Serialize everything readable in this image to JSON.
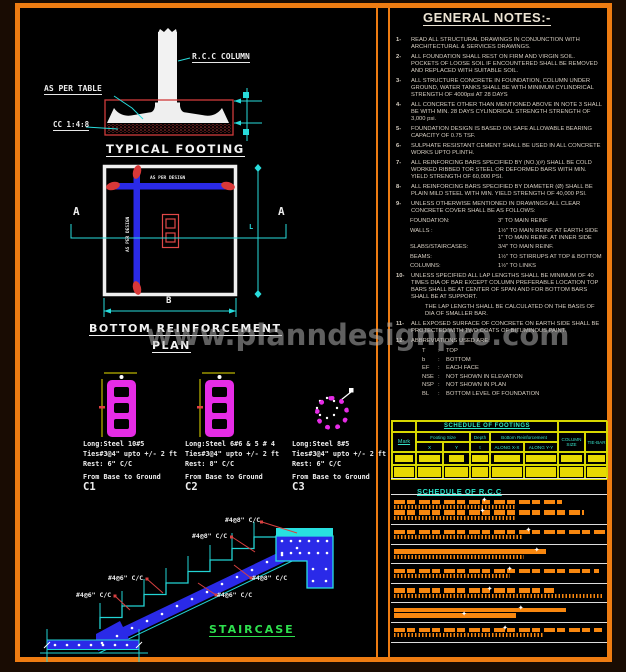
{
  "watermark": "www.planndesignpro.com",
  "footing_detail": {
    "title": "TYPICAL FOOTING",
    "column_label": "R.C.C COLUMN",
    "table_label": "AS PER TABLE",
    "cc_label": "CC 1:4:8"
  },
  "plan": {
    "title": "BOTTOM REINFORCEMENT",
    "title2": "PLAN",
    "bar_label": "AS PER DESIGN",
    "section_mark": "A",
    "dim_width": "B",
    "dim_len": "L"
  },
  "columns": [
    {
      "long": "Long:Steel  10#5",
      "ties": "Ties#3@4\" upto +/- 2 ft",
      "rest": "Rest: 6\" C/C",
      "range": "From Base to Ground",
      "mark": "C1"
    },
    {
      "long": "Long:Steel  6#6 & 5 # 4",
      "ties": "Ties#3@4\" upto +/- 2 ft",
      "rest": "Rest: 8\" C/C",
      "range": "From Base to Ground",
      "mark": "C2"
    },
    {
      "long": "Long:Steel  8#5",
      "ties": "Ties#3@4\" upto +/- 2 ft",
      "rest": "Rest: 6\" C/C",
      "range": "From Base to Ground",
      "mark": "C3"
    }
  ],
  "staircase": {
    "title": "STAIRCASE",
    "labels": [
      "#4@8\" C/C",
      "#4@8\" C/C",
      "#4@8\" C/C",
      "#4@6\" C/C",
      "#4@6\" C/C",
      "#4@6\" C/C"
    ]
  },
  "notes": {
    "title": "GENERAL NOTES:-",
    "blocks": [
      {
        "t": "note",
        "n": "1-",
        "x": "READ ALL STRUCTURAL DRAWINGS IN CONJUNCTION WITH ARCHITECTURAL & SERVICES DRAWINGS."
      },
      {
        "t": "note",
        "n": "2-",
        "x": "ALL FOUNDATION SHALL REST ON FIRM AND VIRGIN SOIL. POCKETS OF LOOSE SOIL IF ENCOUNTERED SHALL BE REMOVED AND REPLACED WITH SUITABLE SOIL."
      },
      {
        "t": "note",
        "n": "3-",
        "x": "ALL STRUCTURE CONCRETE IN FOUNDATION, COLUMN UNDER GROUND, WATER TANKS SHALL BE WITH MINIMUM CYLINDRICAL STRENGTH OF 4000psi AT 28 DAYS"
      },
      {
        "t": "note",
        "n": "4-",
        "x": "ALL CONCRETE OTHER THAN MENTIONED ABOVE IN NOTE 3 SHALL BE WITH MIN. 28 DAYS CYLINDRICAL STRENGTH STRENGTH OF 3,000 psi."
      },
      {
        "t": "note",
        "n": "5-",
        "x": "FOUNDATION DESIGN IS BASED ON SAFE ALLOWABLE BEARING CAPACITY OF 0.75 TSF."
      },
      {
        "t": "note",
        "n": "6-",
        "x": "SULPHATE RESISTANT CEMENT SHALL BE USED IN ALL CONCRETE WORKS UPTO PLINTH."
      },
      {
        "t": "note",
        "n": "7-",
        "x": "ALL REINFORCING BARS SPECIFIED BY (NO.)(#) SHALL BE COLD WORKED RIBBED TOR STEEL OR DEFORMED BARS WITH MIN. YIELD STRENGTH OF 60,000 PSI."
      },
      {
        "t": "note",
        "n": "8-",
        "x": "ALL REINFORCING BARS SPECIFIED BY DIAMETER (Ø) SHALL BE PLAIN MILD STEEL WITH MIN. YIELD STRENGTH OF 40,000 PSI."
      },
      {
        "t": "note",
        "n": "9-",
        "x": "UNLESS OTHERWISE MENTIONED IN DRAWINGS ALL CLEAR CONCRETE COVER SHALL BE AS FOLLOWS:"
      },
      {
        "t": "pair",
        "l": "FOUNDATION:",
        "v": "3\" TO MAIN REINF"
      },
      {
        "t": "pair",
        "l": "WALLS :",
        "v": "1½\" TO MAIN REINF. AT EARTH SIDE\n1\" TO MAIN REINF. AT INNER SIDE"
      },
      {
        "t": "pair",
        "l": "SLABS/STAIRCASES:",
        "v": "3/4\" TO MAIN REINF."
      },
      {
        "t": "pair",
        "l": "BEAMS:",
        "v": "1½\" TO STIRRUPS AT TOP & BOTTOM"
      },
      {
        "t": "pair",
        "l": "COLUMNS:",
        "v": "1½\" TO LINKS"
      },
      {
        "t": "note",
        "n": "10-",
        "x": "UNLESS SPECIFIED ALL LAP LENGTHS SHALL BE MINIMUM OF 40 TIMES DIA OF BAR EXCEPT COLUMN PREFERABLE LOCATION TOP BARS SHALL BE AT CENTER OF SPAN AND FOR BOTTOM BARS SHALL BE AT SUPPORT."
      },
      {
        "t": "cont",
        "x": "THE LAP LENGTH SHALL BE CALCULATED ON THE BASIS OF DIA OF SMALLER BAR."
      },
      {
        "t": "note",
        "n": "11-",
        "x": "ALL EXPOSED SURFACE OF CONCRETE ON EARTH SIDE SHALL BE PROTECTED WITH TWO COATS OF BITUMINOUS PAINT."
      },
      {
        "t": "note",
        "n": "12-",
        "x": "ABBREVIATIONS USED ARE:"
      },
      {
        "t": "abbr",
        "l": "T",
        "v": "TOP"
      },
      {
        "t": "abbr",
        "l": "b",
        "v": "BOTTOM"
      },
      {
        "t": "abbr",
        "l": "EF",
        "v": "EACH FACE"
      },
      {
        "t": "abbr",
        "l": "NSE",
        "v": "NOT SHOWN IN ELEVATION"
      },
      {
        "t": "abbr",
        "l": "NSP",
        "v": "NOT SHOWN IN PLAN"
      },
      {
        "t": "abbr",
        "l": "BL",
        "v": "BOTTOM LEVEL OF FOUNDATION"
      }
    ]
  },
  "footing_schedule": {
    "title": "SCHEDULE OF FOOTINGS",
    "col_mark": "Mark",
    "grp_size": "Footing Size",
    "grp_depth": "Depth",
    "grp_reinf": "Bottom Reinforcement",
    "sub_x": "X",
    "sub_y": "Y",
    "sub_t": "t",
    "sub_ax": "ALONG X-X",
    "sub_ay": "ALONG Y-Y",
    "col_size": "COLUMN SIZE",
    "col_tie": "TIE-BAR"
  },
  "rcc_schedule": {
    "title": "SCHEDULE OF R.C.C",
    "groups": [
      {
        "rows": [
          {
            "s": "blocks",
            "w": 168,
            "star": 0.52
          },
          {
            "s": "ticks",
            "w": 122
          },
          {
            "s": "blocks",
            "w": 190,
            "star": 0.45
          },
          {
            "s": "ticks",
            "w": 122
          }
        ]
      },
      {
        "rows": [
          {
            "s": "blocks",
            "w": 212,
            "star": 0.62
          },
          {
            "s": "ticks",
            "w": 128
          }
        ]
      },
      {
        "rows": [
          {
            "s": "plain",
            "w": 152,
            "star": 0.92
          },
          {
            "s": "ticks",
            "w": 130
          }
        ]
      },
      {
        "rows": [
          {
            "s": "blocks",
            "w": 205,
            "star": 0.55
          },
          {
            "s": "ticks",
            "w": 116
          }
        ]
      },
      {
        "rows": [
          {
            "s": "blocks",
            "w": 160,
            "star": 0.58
          },
          {
            "s": "ticks",
            "w": 210
          }
        ]
      },
      {
        "rows": [
          {
            "s": "plain",
            "w": 172,
            "star": 0.72
          },
          {
            "s": "plain",
            "w": 122,
            "star": 0.55
          }
        ]
      },
      {
        "rows": [
          {
            "s": "blocks",
            "w": 208,
            "star": 0.52
          },
          {
            "s": "ticks",
            "w": 150
          }
        ]
      }
    ]
  },
  "colors": {
    "frame_orange": "#ee7c12",
    "cad_cyan": "#28dcdc",
    "cad_yellow": "#e8d800",
    "cad_magenta": "#e62ce6",
    "cad_blue": "#2a2ae8",
    "cad_red": "#d84040",
    "cad_green": "#2ee04e",
    "schedule_orange": "#f8870f"
  }
}
